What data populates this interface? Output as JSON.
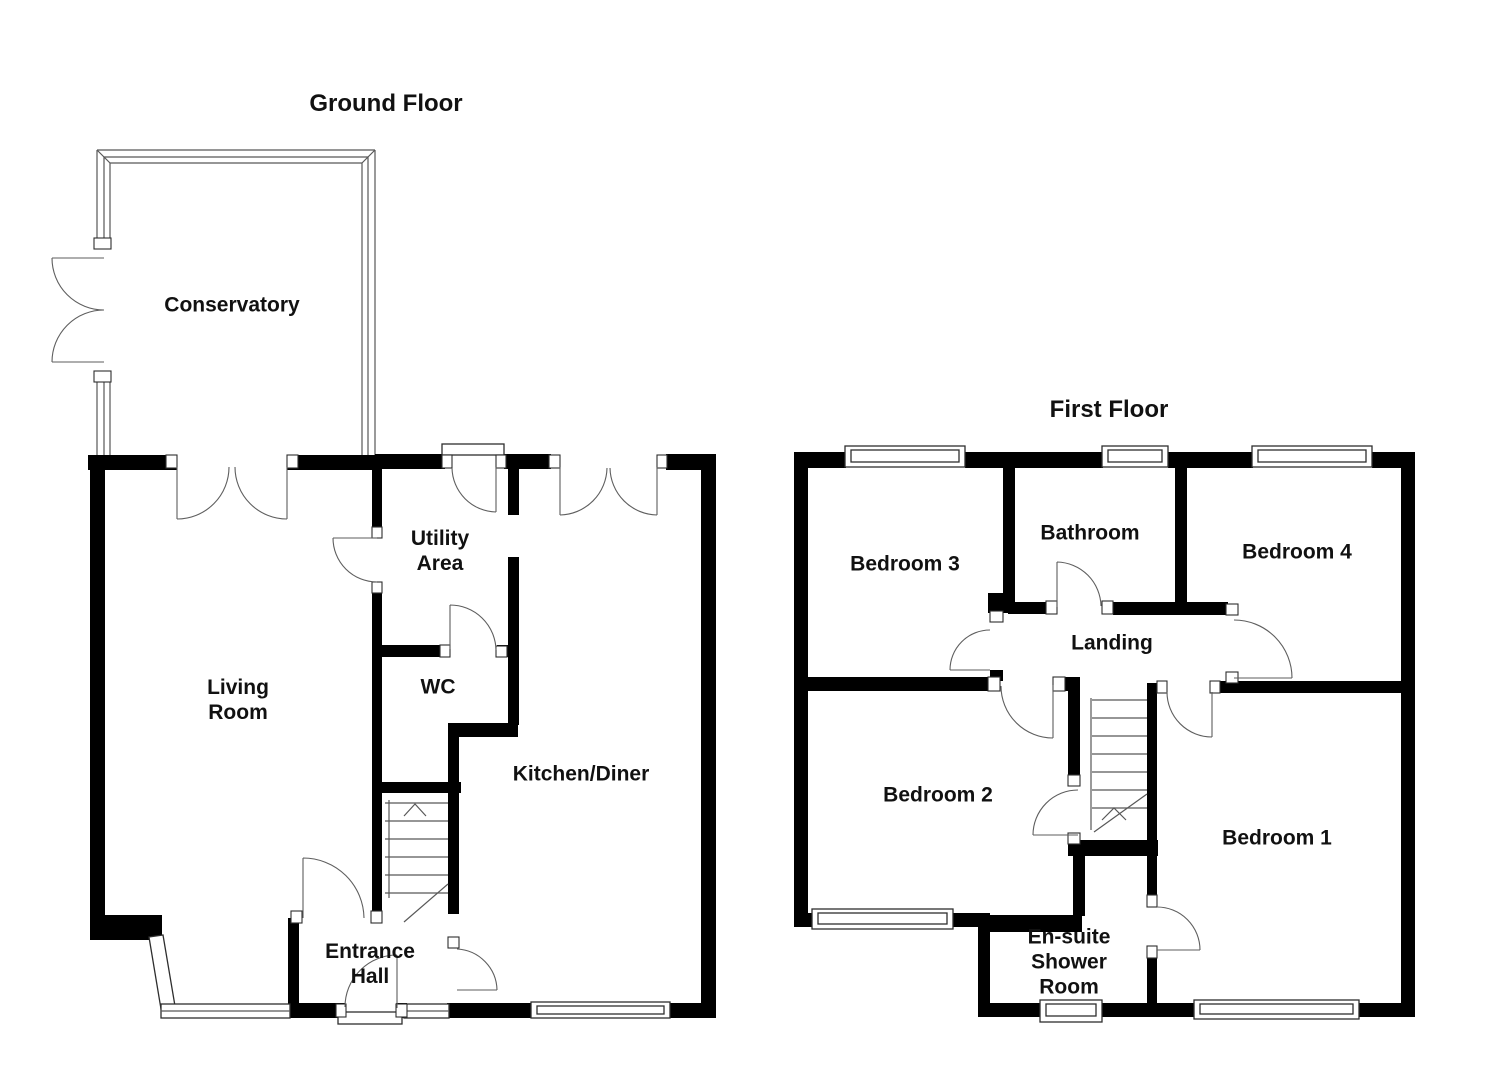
{
  "document_type": "property-floorplan",
  "colors": {
    "wall": "#000000",
    "background": "#ffffff",
    "text": "#111111"
  },
  "floors": [
    {
      "id": "ground",
      "title": "Ground Floor",
      "rooms": [
        {
          "label": "Conservatory",
          "lines": [
            "Conservatory"
          ]
        },
        {
          "label": "Living Room",
          "lines": [
            "Living",
            "Room"
          ]
        },
        {
          "label": "Utility Area",
          "lines": [
            "Utility",
            "Area"
          ]
        },
        {
          "label": "WC",
          "lines": [
            "WC"
          ]
        },
        {
          "label": "Kitchen/Diner",
          "lines": [
            "Kitchen/Diner"
          ]
        },
        {
          "label": "Entrance Hall",
          "lines": [
            "Entrance",
            "Hall"
          ]
        }
      ],
      "features": [
        "staircase-up",
        "french-doors",
        "bay-window",
        "front-door"
      ]
    },
    {
      "id": "first",
      "title": "First Floor",
      "rooms": [
        {
          "label": "Bedroom 3",
          "lines": [
            "Bedroom 3"
          ]
        },
        {
          "label": "Bathroom",
          "lines": [
            "Bathroom"
          ]
        },
        {
          "label": "Bedroom 4",
          "lines": [
            "Bedroom 4"
          ]
        },
        {
          "label": "Landing",
          "lines": [
            "Landing"
          ]
        },
        {
          "label": "Bedroom 2",
          "lines": [
            "Bedroom 2"
          ]
        },
        {
          "label": "Bedroom 1",
          "lines": [
            "Bedroom 1"
          ]
        },
        {
          "label": "En-suite Shower Room",
          "lines": [
            "En-suite",
            "Shower",
            "Room"
          ]
        }
      ],
      "features": [
        "staircase",
        "landing-doors",
        "built-in-cupboard"
      ]
    }
  ]
}
